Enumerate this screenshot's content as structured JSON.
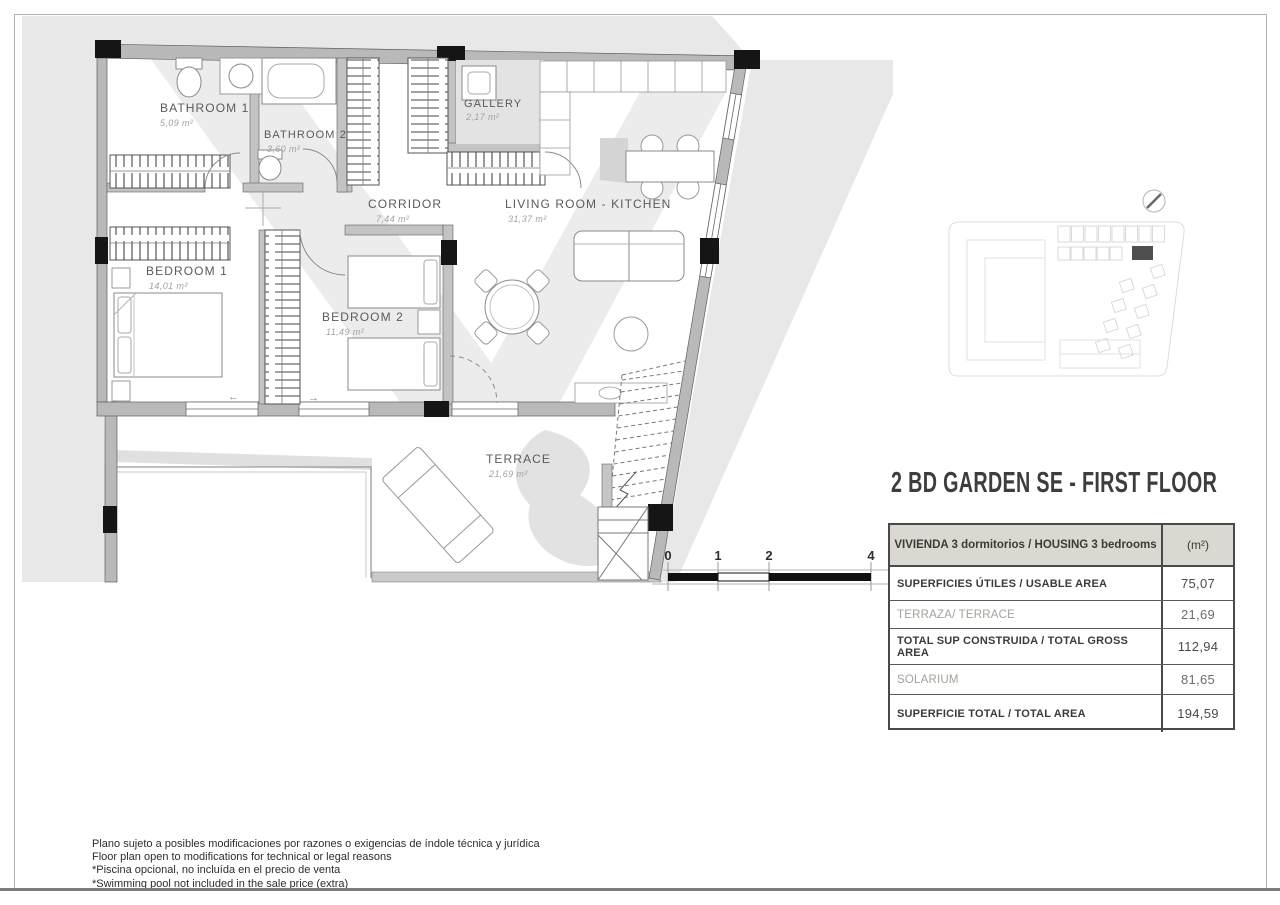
{
  "document": {
    "title": "2 BD GARDEN SE - FIRST FLOOR"
  },
  "rooms": {
    "bathroom1": {
      "name": "BATHROOM 1",
      "area": "5,09 m²"
    },
    "bathroom2": {
      "name": "BATHROOM 2",
      "area": "3,60 m²"
    },
    "gallery": {
      "name": "GALLERY",
      "area": "2,17 m²"
    },
    "corridor": {
      "name": "CORRIDOR",
      "area": "7,44 m²"
    },
    "living": {
      "name": "LIVING ROOM - KITCHEN",
      "area": "31,37 m²"
    },
    "bedroom1": {
      "name": "BEDROOM 1",
      "area": "14,01 m²"
    },
    "bedroom2": {
      "name": "BEDROOM 2",
      "area": "11,49 m²"
    },
    "terrace": {
      "name": "TERRACE",
      "area": "21,69 m²"
    }
  },
  "symbols": {
    "arrow_left": "←",
    "arrow_right": "→"
  },
  "scale_bar": {
    "labels": [
      "0",
      "1",
      "2",
      "4"
    ]
  },
  "area_table": {
    "header": {
      "label": "VIVIENDA 3 dormitorios / HOUSING 3 bedrooms",
      "unit": "(m²)"
    },
    "rows": [
      {
        "label": "SUPERFICIES ÚTILES / USABLE AREA",
        "value": "75,07",
        "style": "bold"
      },
      {
        "label": "TERRAZA/ TERRACE",
        "value": "21,69",
        "style": "light"
      },
      {
        "label": "TOTAL SUP CONSTRUIDA / TOTAL GROSS AREA",
        "value": "112,94",
        "style": "bold"
      },
      {
        "label": "SOLARIUM",
        "value": "81,65",
        "style": "light"
      },
      {
        "label": "SUPERFICIE TOTAL / TOTAL  AREA",
        "value": "194,59",
        "style": "bold"
      }
    ]
  },
  "footer": {
    "lines": [
      "Plano sujeto a posibles modificaciones por razones o exigencias de índole técnica y jurídica",
      "Floor plan open to modifications for technical or legal reasons",
      "*Piscina opcional, no incluída en el precio de venta",
      "*Swimming pool not included in the sale price (extra)"
    ]
  },
  "colors": {
    "wall_gray": "#b9b9b9",
    "partition_gray": "#c3c3c3",
    "column_black": "#151515",
    "shadow_gray": "#e8e8e8",
    "table_header_bg": "#dbd7d1",
    "title_text": "#3d3d3d",
    "keymap_highlight": "#4f4f4f"
  }
}
